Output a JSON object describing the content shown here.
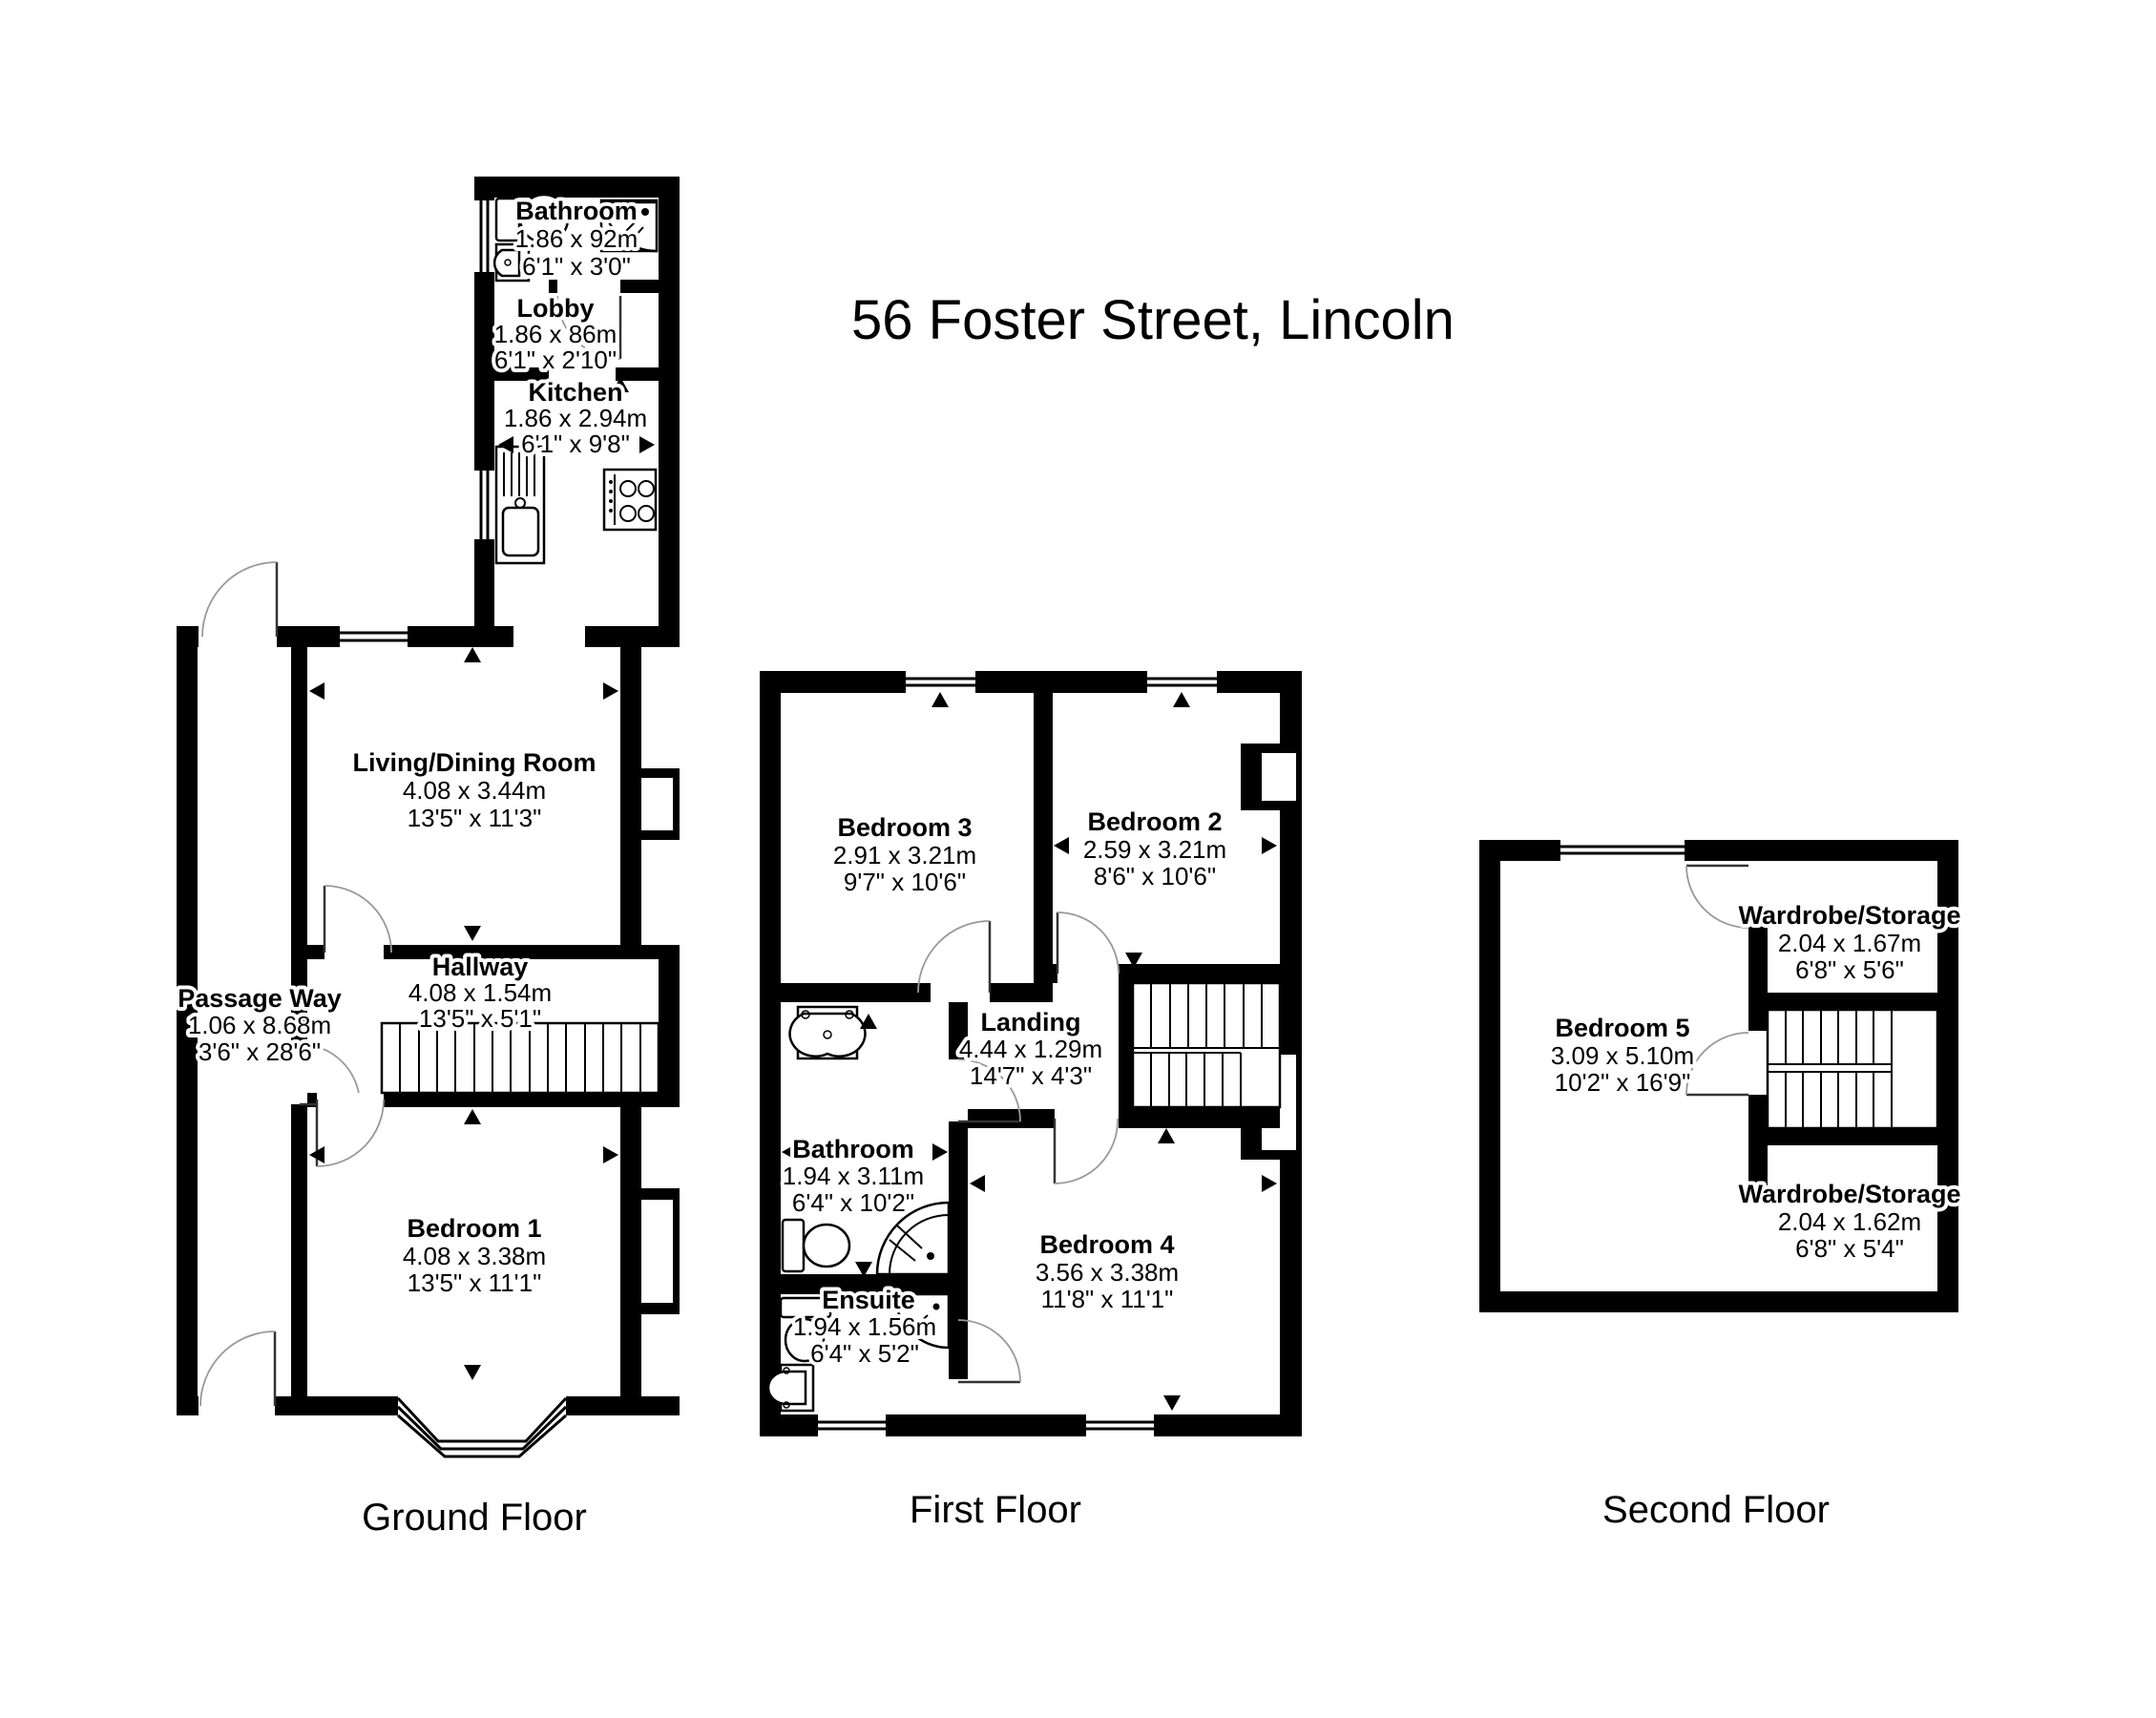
{
  "title": "56 Foster Street, Lincoln",
  "floors": {
    "ground": {
      "label": "Ground Floor",
      "rooms": {
        "bathroom": {
          "name": "Bathroom",
          "metric": "1.86 x 92m",
          "imperial": "6'1\" x 3'0\""
        },
        "lobby": {
          "name": "Lobby",
          "metric": "1.86 x 86m",
          "imperial": "6'1\" x 2'10\""
        },
        "kitchen": {
          "name": "Kitchen",
          "metric": "1.86 x 2.94m",
          "imperial": "6'1\" x 9'8\""
        },
        "living_dining": {
          "name": "Living/Dining Room",
          "metric": "4.08 x 3.44m",
          "imperial": "13'5\" x 11'3\""
        },
        "hallway": {
          "name": "Hallway",
          "metric": "4.08 x 1.54m",
          "imperial": "13'5\" x 5'1\""
        },
        "passage": {
          "name": "Passage Way",
          "metric": "1.06 x 8.68m",
          "imperial": "3'6\" x 28'6\""
        },
        "bedroom1": {
          "name": "Bedroom 1",
          "metric": "4.08 x 3.38m",
          "imperial": "13'5\" x 11'1\""
        }
      }
    },
    "first": {
      "label": "First Floor",
      "rooms": {
        "bedroom3": {
          "name": "Bedroom 3",
          "metric": "2.91 x 3.21m",
          "imperial": "9'7\" x 10'6\""
        },
        "bedroom2": {
          "name": "Bedroom 2",
          "metric": "2.59 x 3.21m",
          "imperial": "8'6\" x 10'6\""
        },
        "landing": {
          "name": "Landing",
          "metric": "4.44 x 1.29m",
          "imperial": "14'7\" x 4'3\""
        },
        "bathroom": {
          "name": "Bathroom",
          "metric": "1.94 x 3.11m",
          "imperial": "6'4\" x 10'2\""
        },
        "ensuite": {
          "name": "Ensuite",
          "metric": "1.94 x 1.56m",
          "imperial": "6'4\" x 5'2\""
        },
        "bedroom4": {
          "name": "Bedroom 4",
          "metric": "3.56 x 3.38m",
          "imperial": "11'8\" x 11'1\""
        }
      }
    },
    "second": {
      "label": "Second Floor",
      "rooms": {
        "wardrobe_top": {
          "name": "Wardrobe/Storage",
          "metric": "2.04 x 1.67m",
          "imperial": "6'8\" x 5'6\""
        },
        "bedroom5": {
          "name": "Bedroom 5",
          "metric": "3.09 x 5.10m",
          "imperial": "10'2\" x 16'9\""
        },
        "wardrobe_bottom": {
          "name": "Wardrobe/Storage",
          "metric": "2.04 x 1.62m",
          "imperial": "6'8\" x 5'4\""
        }
      }
    }
  }
}
